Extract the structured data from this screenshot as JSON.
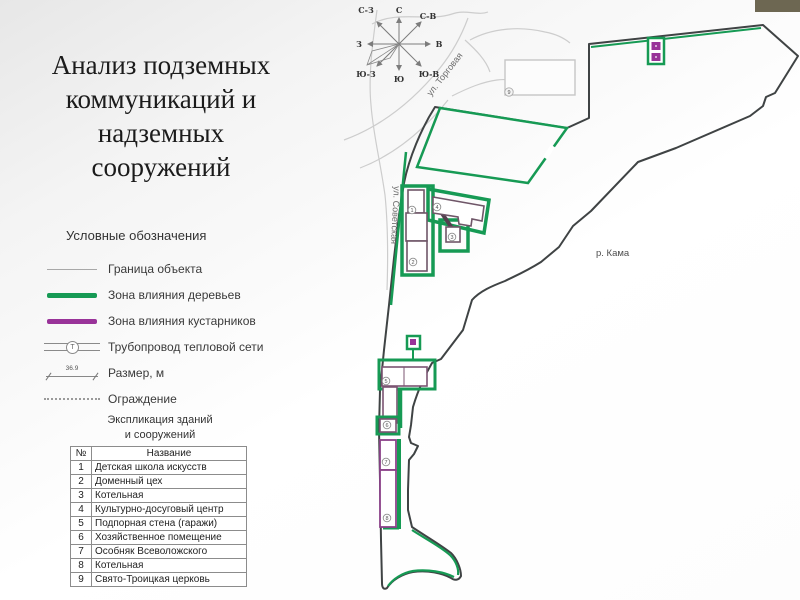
{
  "slide": {
    "title_lines": [
      "Анализ подземных",
      "коммуникаций и",
      "надземных",
      "сооружений"
    ]
  },
  "legend": {
    "header": "Условные обозначения",
    "items": [
      {
        "type": "boundary",
        "label": "Граница объекта"
      },
      {
        "type": "trees",
        "label": "Зона влияния деревьев"
      },
      {
        "type": "shrubs",
        "label": "Зона влияния кустарников"
      },
      {
        "type": "heat-pipe",
        "label": "Трубопровод тепловой сети"
      },
      {
        "type": "dimension",
        "label": "Размер, м"
      },
      {
        "type": "fence",
        "label": "Ограждение"
      }
    ],
    "pipe_letter": "Т",
    "dim_value": "36.9",
    "explication_line1": "Экспликация зданий",
    "explication_line2": "и сооружений"
  },
  "table": {
    "col_num": "№",
    "col_name": "Название",
    "rows": [
      {
        "num": "1",
        "name": "Детская школа искусств"
      },
      {
        "num": "2",
        "name": "Доменный цех"
      },
      {
        "num": "3",
        "name": "Котельная"
      },
      {
        "num": "4",
        "name": "Культурно-досуговый центр"
      },
      {
        "num": "5",
        "name": "Подпорная стена (гаражи)"
      },
      {
        "num": "6",
        "name": "Хозяйственное помещение"
      },
      {
        "num": "7",
        "name": "Особняк Всеволожского"
      },
      {
        "num": "8",
        "name": "Котельная"
      },
      {
        "num": "9",
        "name": "Свято-Троицкая церковь"
      }
    ]
  },
  "map": {
    "compass": {
      "n": "С",
      "ne": "С-В",
      "e": "В",
      "se": "Ю-В",
      "s": "Ю",
      "sw": "Ю-З",
      "w": "З",
      "nw": "С-З"
    },
    "streets": {
      "torgovaya": "ул. Торговая",
      "sovetskaya": "ул. Советская"
    },
    "river": "р. Кама",
    "markers": [
      {
        "n": "1"
      },
      {
        "n": "2"
      },
      {
        "n": "3"
      },
      {
        "n": "4"
      },
      {
        "n": "5"
      },
      {
        "n": "6"
      },
      {
        "n": "7"
      },
      {
        "n": "8"
      },
      {
        "n": "9"
      }
    ]
  },
  "colors": {
    "tree_zone": "#169a54",
    "shrub_zone": "#993399",
    "site_boundary": "#3f4344",
    "street_line": "#cdcdcd",
    "accent_bar": "#6d6752"
  }
}
